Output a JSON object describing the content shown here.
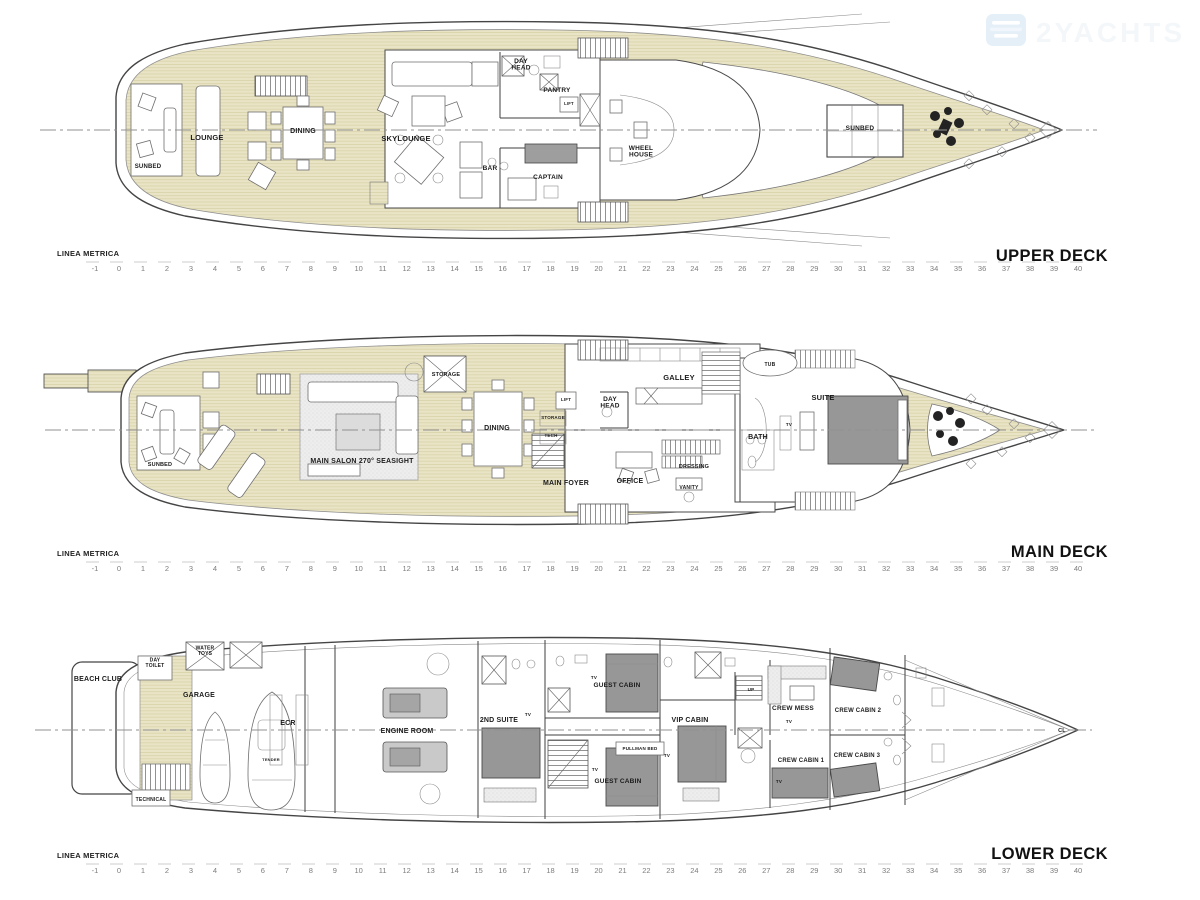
{
  "watermark": {
    "text": "2YACHTS",
    "icon": "yacht-logo",
    "icon_color": "#d3e5f3"
  },
  "colors": {
    "teak_deck": "#e9e4c5",
    "teak_line": "#d7d0a6",
    "hull_outline": "#454545",
    "furniture_bed_gray": "#979797",
    "label_text": "#1b1b1b",
    "ruler_text": "#7d7d7d"
  },
  "rulers": {
    "label": "LINEA METRICA",
    "start": -1,
    "end": 40
  },
  "decks": [
    {
      "name": "UPPER DECK",
      "rooms": [
        {
          "label": "LOUNGE",
          "x": 207,
          "y": 140,
          "size": 7.5
        },
        {
          "label": "DINING",
          "x": 303,
          "y": 133,
          "size": 7
        },
        {
          "label": "SKYLOUNGE",
          "x": 406,
          "y": 141,
          "size": 7.5
        },
        {
          "label": "SUNBED",
          "x": 148,
          "y": 168,
          "size": 6
        },
        {
          "label": "DAY\nHEAD",
          "x": 521,
          "y": 66,
          "size": 6.5
        },
        {
          "label": "PANTRY",
          "x": 557,
          "y": 92,
          "size": 6.5
        },
        {
          "label": "LIFT",
          "x": 569,
          "y": 105,
          "size": 4.2
        },
        {
          "label": "BAR",
          "x": 490,
          "y": 170,
          "size": 6.5
        },
        {
          "label": "CAPTAIN",
          "x": 548,
          "y": 179,
          "size": 6.5
        },
        {
          "label": "WHEEL\nHOUSE",
          "x": 641,
          "y": 153,
          "size": 6.5
        },
        {
          "label": "SUNBED",
          "x": 860,
          "y": 130,
          "size": 6.5
        }
      ]
    },
    {
      "name": "MAIN DECK",
      "rooms": [
        {
          "label": "SUNBED",
          "x": 160,
          "y": 466,
          "size": 5.5
        },
        {
          "label": "MAIN SALON 270° SEASIGHT",
          "x": 362,
          "y": 463,
          "size": 7
        },
        {
          "label": "STORAGE",
          "x": 446,
          "y": 376,
          "size": 5.5
        },
        {
          "label": "DINING",
          "x": 497,
          "y": 430,
          "size": 7
        },
        {
          "label": "STORAGE",
          "x": 553,
          "y": 419,
          "size": 4.5
        },
        {
          "label": "TECH",
          "x": 551,
          "y": 437,
          "size": 4.5
        },
        {
          "label": "LIFT",
          "x": 566,
          "y": 401,
          "size": 4.5
        },
        {
          "label": "DAY\nHEAD",
          "x": 610,
          "y": 404,
          "size": 6.5
        },
        {
          "label": "MAIN FOYER",
          "x": 566,
          "y": 485,
          "size": 7
        },
        {
          "label": "OFFICE",
          "x": 630,
          "y": 483,
          "size": 7
        },
        {
          "label": "GALLEY",
          "x": 679,
          "y": 380,
          "size": 7.5
        },
        {
          "label": "TUB",
          "x": 770,
          "y": 366,
          "size": 5
        },
        {
          "label": "BATH",
          "x": 758,
          "y": 439,
          "size": 7
        },
        {
          "label": "DRESSING",
          "x": 694,
          "y": 468,
          "size": 5.5
        },
        {
          "label": "VANITY",
          "x": 689,
          "y": 489,
          "size": 5
        },
        {
          "label": "SUITE",
          "x": 823,
          "y": 400,
          "size": 7.5
        },
        {
          "label": "TV",
          "x": 789,
          "y": 426,
          "size": 4.5
        }
      ]
    },
    {
      "name": "LOWER DECK",
      "rooms": [
        {
          "label": "BEACH CLUB",
          "x": 98,
          "y": 681,
          "size": 7
        },
        {
          "label": "DAY\nTOILET",
          "x": 155,
          "y": 664,
          "size": 5
        },
        {
          "label": "WATER\nTOYS",
          "x": 205,
          "y": 652,
          "size": 5
        },
        {
          "label": "GARAGE",
          "x": 199,
          "y": 697,
          "size": 7
        },
        {
          "label": "TENDER",
          "x": 271,
          "y": 761,
          "size": 4
        },
        {
          "label": "ECR",
          "x": 288,
          "y": 725,
          "size": 7
        },
        {
          "label": "ENGINE ROOM",
          "x": 407,
          "y": 733,
          "size": 7
        },
        {
          "label": "TECHNICAL",
          "x": 151,
          "y": 801,
          "size": 5
        },
        {
          "label": "2ND SUITE",
          "x": 499,
          "y": 722,
          "size": 7
        },
        {
          "label": "GUEST CABIN",
          "x": 617,
          "y": 687,
          "size": 6.5
        },
        {
          "label": "PULLMAN BED",
          "x": 640,
          "y": 750,
          "size": 4.5
        },
        {
          "label": "GUEST CABIN",
          "x": 618,
          "y": 783,
          "size": 6.5
        },
        {
          "label": "VIP CABIN",
          "x": 690,
          "y": 722,
          "size": 7
        },
        {
          "label": "CREW MESS",
          "x": 793,
          "y": 710,
          "size": 6.5
        },
        {
          "label": "CREW CABIN 1",
          "x": 801,
          "y": 762,
          "size": 6
        },
        {
          "label": "CREW CABIN 2",
          "x": 858,
          "y": 712,
          "size": 6
        },
        {
          "label": "CREW CABIN 3",
          "x": 857,
          "y": 757,
          "size": 6
        },
        {
          "label": "UP",
          "x": 751,
          "y": 691,
          "size": 4.5
        },
        {
          "label": "CL",
          "x": 1062,
          "y": 732,
          "size": 5.5
        },
        {
          "label": "TV",
          "x": 594,
          "y": 679,
          "size": 4.5
        },
        {
          "label": "TV",
          "x": 528,
          "y": 716,
          "size": 4.5
        },
        {
          "label": "TV",
          "x": 595,
          "y": 771,
          "size": 4.5
        },
        {
          "label": "TV",
          "x": 667,
          "y": 757,
          "size": 4.5
        },
        {
          "label": "TV",
          "x": 789,
          "y": 723,
          "size": 4.5
        },
        {
          "label": "TV",
          "x": 779,
          "y": 783,
          "size": 4.5
        }
      ]
    }
  ]
}
